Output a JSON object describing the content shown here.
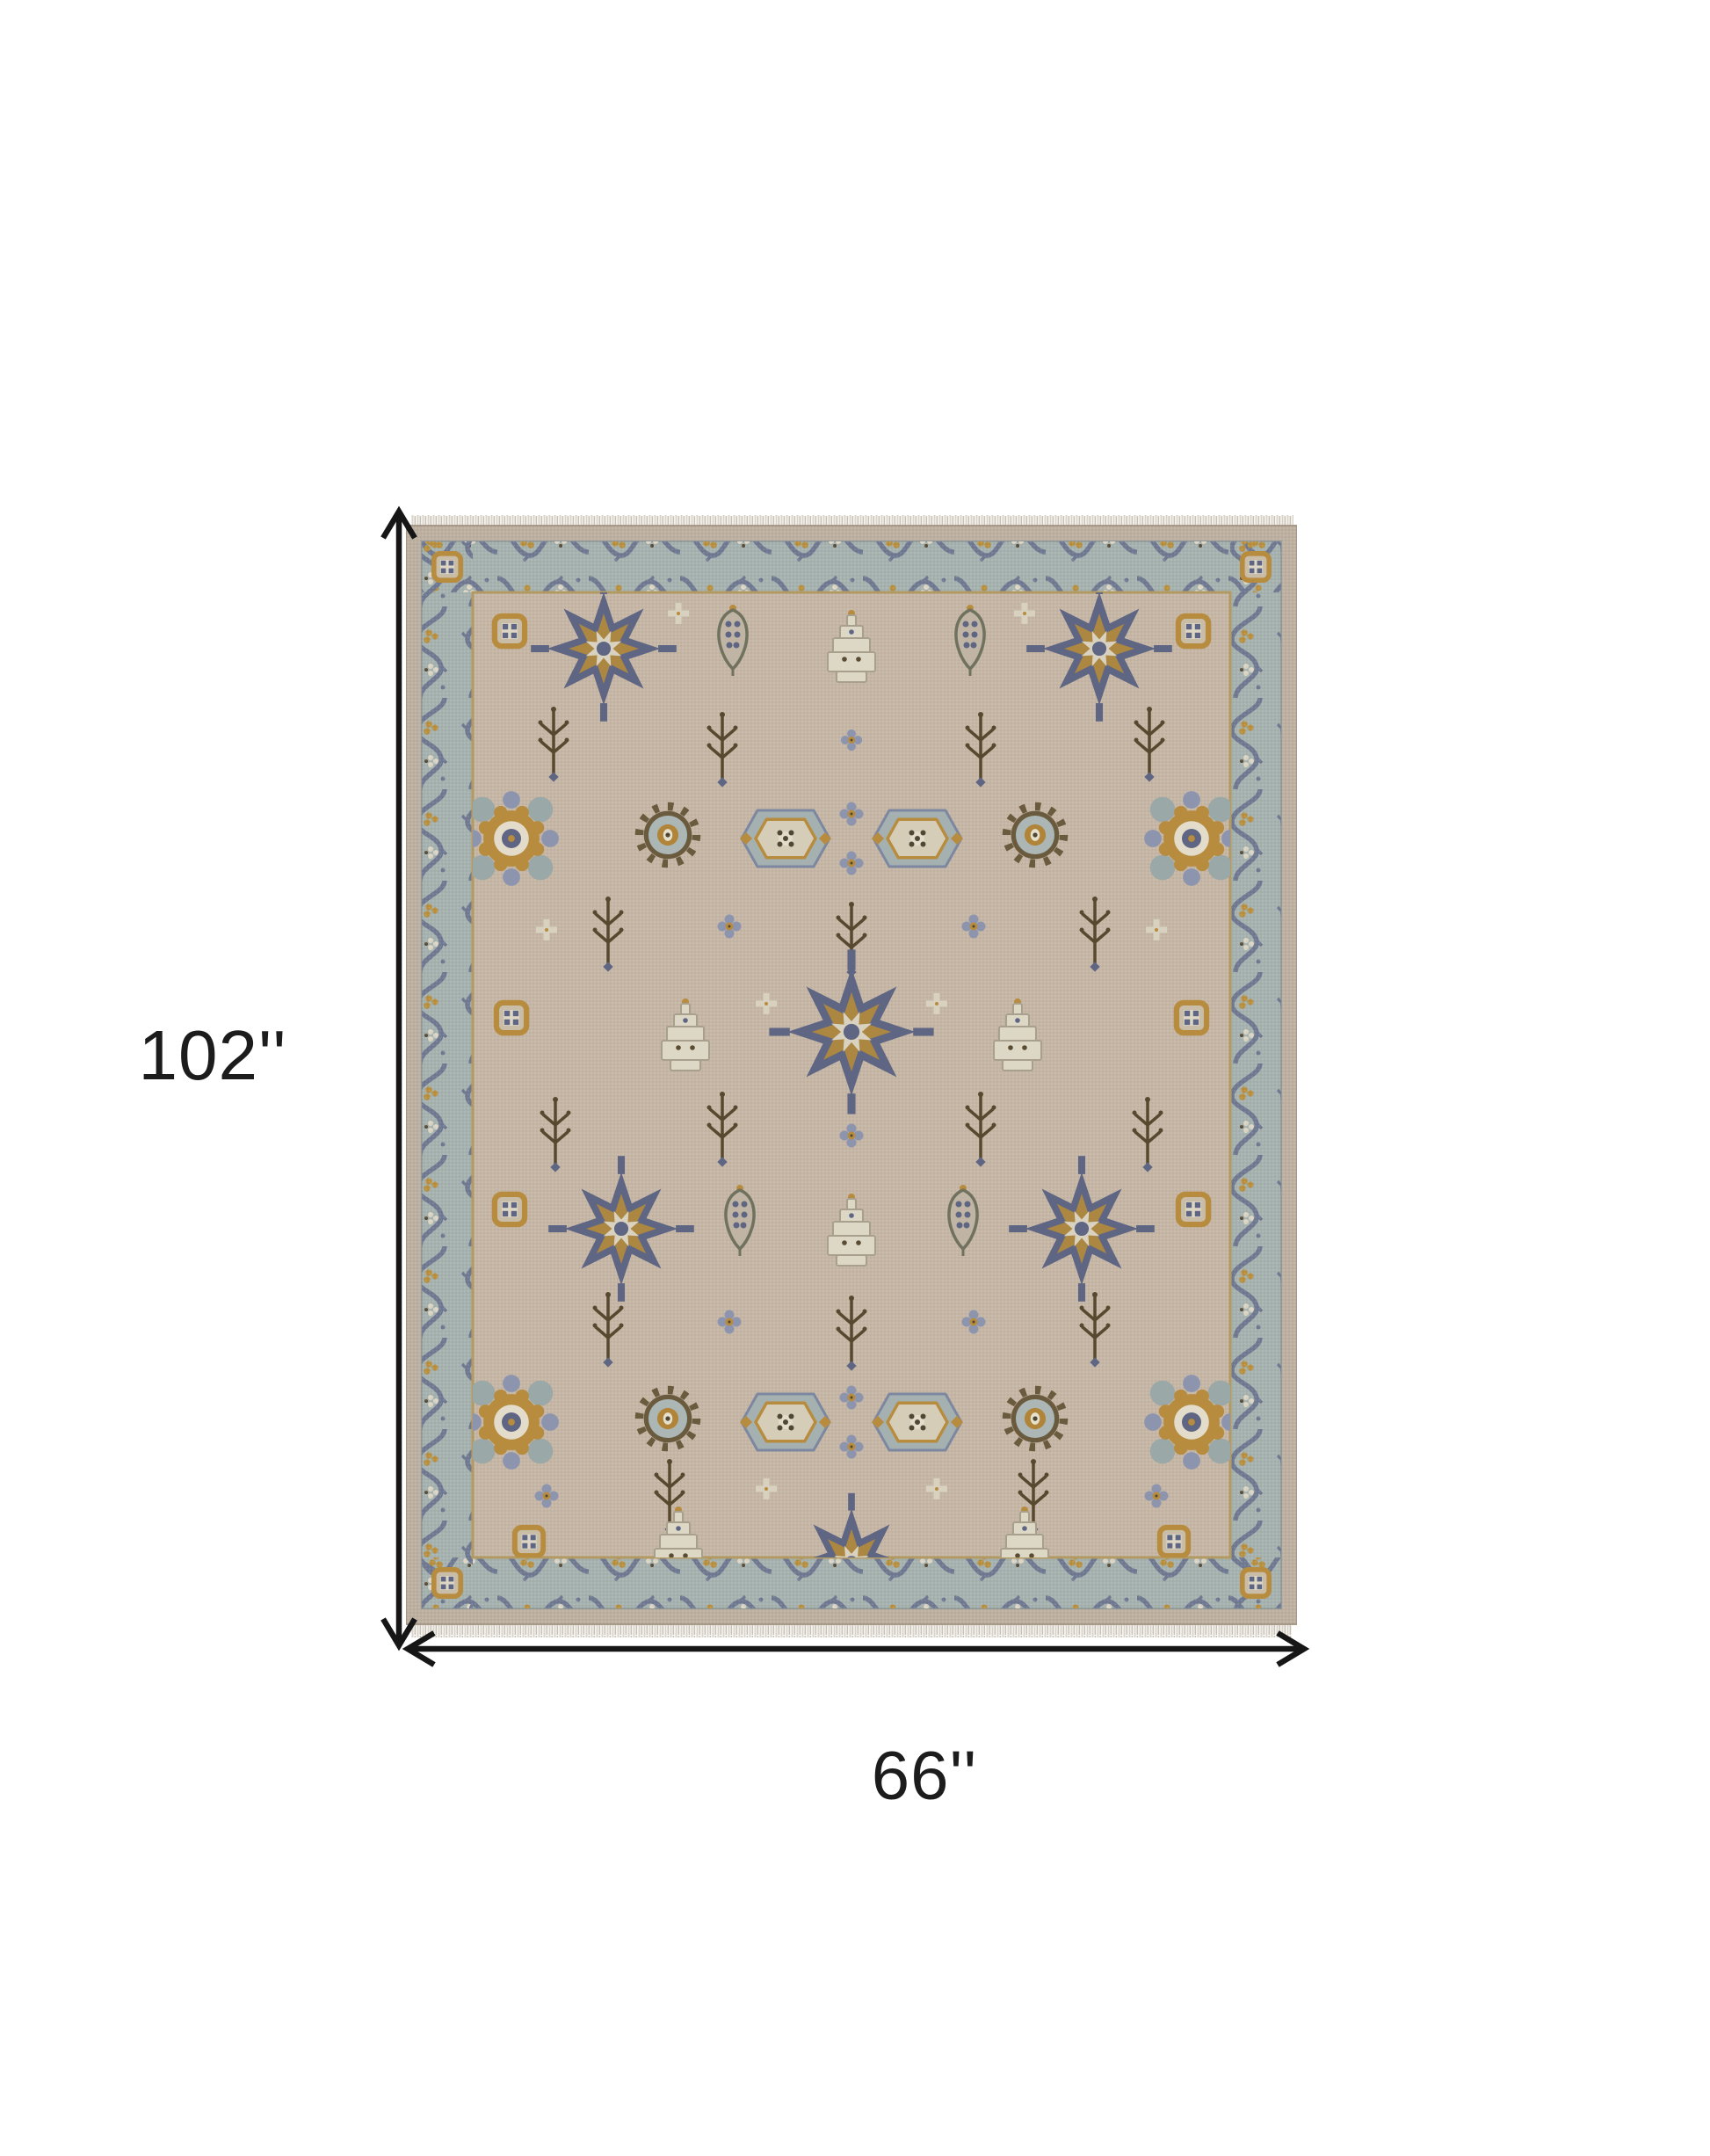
{
  "page": {
    "background_color": "#ffffff"
  },
  "diagram": {
    "subject": "ornate oriental area rug, top view, with dimension arrows",
    "height_dimension": {
      "label": "102''"
    },
    "width_dimension": {
      "label": "66''"
    },
    "arrow_color": "#161616"
  },
  "rug": {
    "palette": {
      "field_beige": "#c6b6a5",
      "outer_edge_beige": "#bdb0a1",
      "border_band_blue_gray": "#a5b2b0",
      "vine_slate": "#6f7992",
      "medallion_slate_blue": "#5f6683",
      "periwinkle": "#8d95ae",
      "gold": "#b78c3e",
      "cream": "#e0dacb",
      "dark_brown": "#57492f",
      "fringe": "#d9d3c8"
    },
    "features": [
      "fringed top and bottom edges",
      "blue-gray scrolling vine border band",
      "all-over field of floral medallions, rosettes and branch motifs"
    ]
  }
}
